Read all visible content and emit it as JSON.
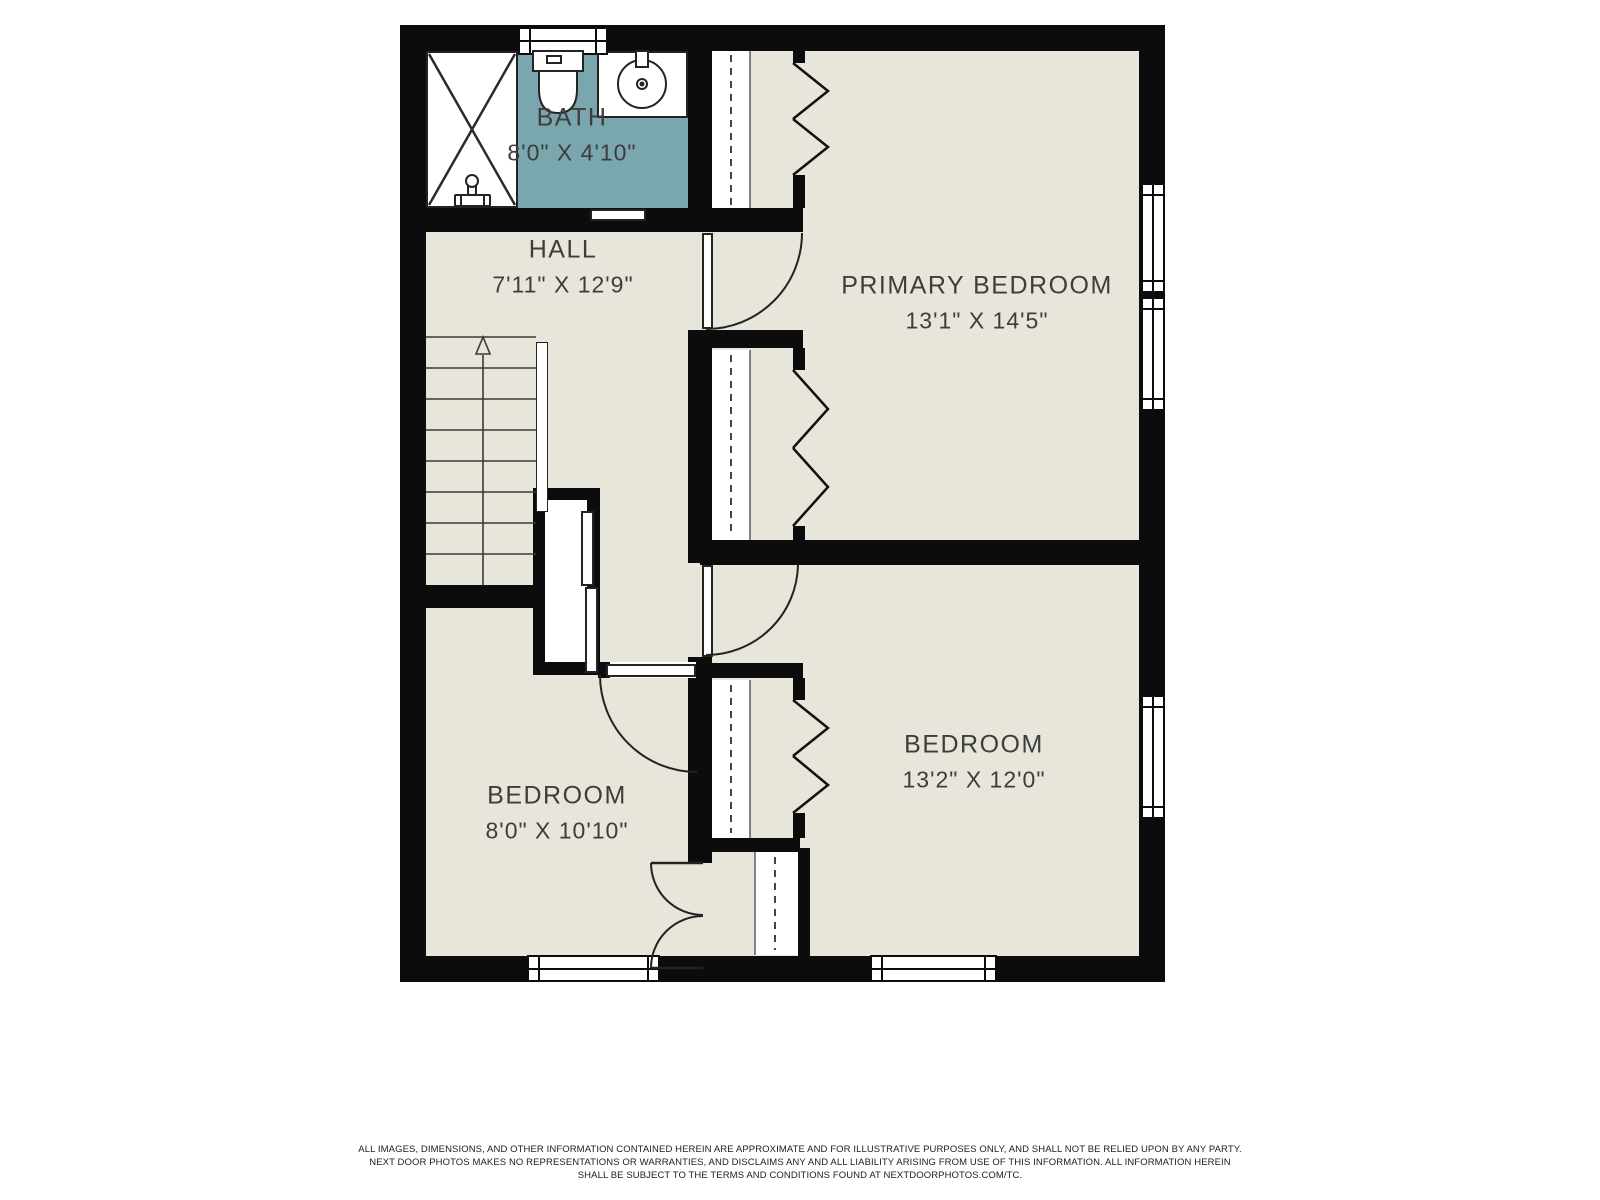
{
  "plan": {
    "rooms": [
      {
        "id": "bath",
        "name": "BATH",
        "dims": "8'0\" X 4'10\""
      },
      {
        "id": "hall",
        "name": "HALL",
        "dims": "7'11\" X 12'9\""
      },
      {
        "id": "primary-bedroom",
        "name": "PRIMARY BEDROOM",
        "dims": "13'1\" X 14'5\""
      },
      {
        "id": "bedroom-right",
        "name": "BEDROOM",
        "dims": "13'2\" X 12'0\""
      },
      {
        "id": "bedroom-left",
        "name": "BEDROOM",
        "dims": "8'0\" X 10'10\""
      }
    ],
    "fixtures": [
      "shower",
      "toilet",
      "sink",
      "stairs-up"
    ]
  },
  "disclaimer": {
    "lines": [
      "ALL IMAGES, DIMENSIONS, AND OTHER INFORMATION CONTAINED HEREIN ARE APPROXIMATE AND FOR ILLUSTRATIVE PURPOSES ONLY, AND SHALL NOT BE RELIED UPON BY ANY PARTY.",
      "NEXT DOOR PHOTOS MAKES NO REPRESENTATIONS OR WARRANTIES, AND DISCLAIMS ANY AND ALL LIABILITY ARISING FROM USE OF THIS INFORMATION. ALL INFORMATION HEREIN",
      "SHALL BE SUBJECT TO THE TERMS AND CONDITIONS FOUND AT NEXTDOORPHOTOS.COM/TC."
    ]
  },
  "colors": {
    "wall": "#0c0c0c",
    "room_floor": "#e8e6da",
    "bath_floor": "#7aa7ae",
    "label_text": "#3d3d3d",
    "line": "#2b2b2b"
  }
}
